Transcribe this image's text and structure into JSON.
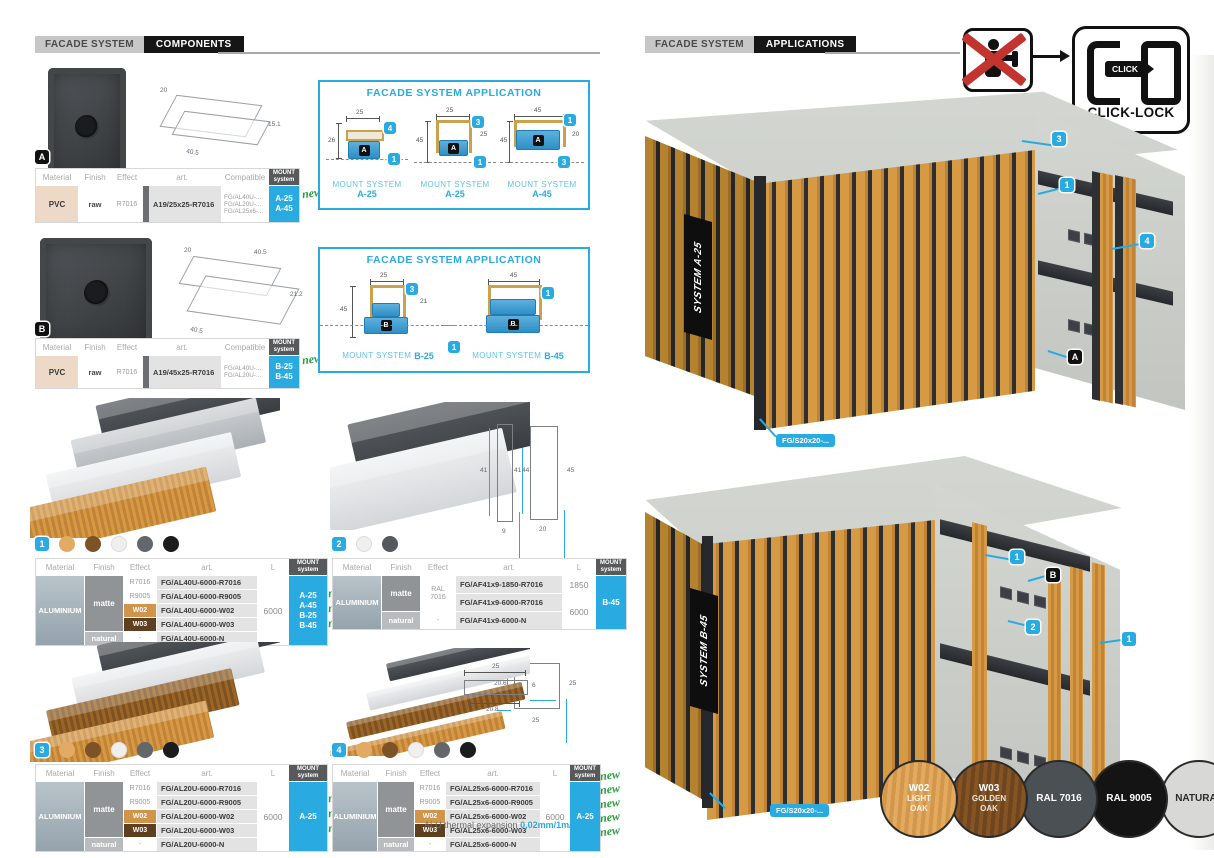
{
  "accent": "#29abe2",
  "labels": {
    "new": "new"
  },
  "table_headers": {
    "material": "Material",
    "finish": "Finish",
    "effect": "Effect",
    "art": "art.",
    "compatible": "Compatible",
    "l": "L",
    "mount1": "MOUNT",
    "mount2": "system"
  },
  "left": {
    "header": {
      "brand": "FACADE SYSTEM",
      "section": "COMPONENTS"
    },
    "compA": {
      "letter": "A",
      "dims": {
        "w": "20",
        "d": "40.5",
        "h": "15.1"
      },
      "table": {
        "material": "PVC",
        "finish": "raw",
        "effect": "R7016",
        "art": "A19/25x25-R7016",
        "compatible": [
          "FG/AL40U-...",
          "FG/AL20U-...",
          "FG/AL25x6-..."
        ],
        "mount": [
          "A-25",
          "A-45"
        ]
      }
    },
    "appA": {
      "title": "FACADE SYSTEM APPLICATION",
      "drawings": [
        {
          "mount_label": "MOUNT SYSTEM",
          "system": "A-25",
          "letter": "A",
          "dim_top": "25",
          "dim_left": "26",
          "dim_right": "6",
          "badge_top": "4",
          "badge_bottom": "1"
        },
        {
          "mount_label": "MOUNT SYSTEM",
          "system": "A-25",
          "letter": "A",
          "dim_top": "25",
          "dim_left": "45",
          "dim_right": "25",
          "badge_top": "3",
          "badge_bottom": "1"
        },
        {
          "mount_label": "MOUNT SYSTEM",
          "system": "A-45",
          "letter": "A",
          "dim_top": "45",
          "dim_left": "45",
          "dim_right": "20",
          "badge_top": "1",
          "badge_bottom": "3"
        }
      ]
    },
    "compB": {
      "letter": "B",
      "dims": {
        "w": "20",
        "d1": "40.5",
        "h": "21.2",
        "d2": "40.5"
      },
      "table": {
        "material": "PVC",
        "finish": "raw",
        "effect": "R7016",
        "art": "A19/45x25-R7016",
        "compatible": [
          "FG/AL40U-...",
          "FG/AL20U-..."
        ],
        "mount": [
          "B-25",
          "B-45"
        ]
      }
    },
    "appB": {
      "title": "FACADE SYSTEM APPLICATION",
      "badge_bottom": "1",
      "drawings": [
        {
          "mount_label": "MOUNT SYSTEM",
          "system": "B-25",
          "letter": "B",
          "dim_top": "25",
          "dim_left": "45",
          "dim_right": "21",
          "badge_top": "3"
        },
        {
          "mount_label": "MOUNT SYSTEM",
          "system": "B-45",
          "letter": "B",
          "dim_top": "45",
          "badge_top": "1"
        }
      ]
    },
    "profile1": {
      "num": "1",
      "dot_colors": [
        "#e2aa62",
        "#7d5226",
        "#efefed",
        "#63666a",
        "#1b1c1e"
      ],
      "dims": {
        "inner": "41",
        "outer": "45",
        "width": "20"
      },
      "table": {
        "material": "ALUMINIUM",
        "finish_matte": "matte",
        "finish_natural": "natural",
        "rows": [
          {
            "effect": "R7016",
            "art": "FG/AL40U-6000-R7016"
          },
          {
            "effect": "R9005",
            "art": "FG/AL40U-6000-R9005"
          },
          {
            "effect": "W02",
            "art": "FG/AL40U-6000-W02"
          },
          {
            "effect": "W03",
            "art": "FG/AL40U-6000-W03"
          },
          {
            "effect": "-",
            "art": "FG/AL40U-6000-N"
          }
        ],
        "length": "6000",
        "mount": [
          "A-25",
          "A-45",
          "B-25",
          "B-45"
        ]
      }
    },
    "profile2": {
      "num": "2",
      "dot_colors": [
        "#efefed",
        "#55585c"
      ],
      "dims": {
        "inner": "41",
        "outer": "44",
        "width": "9"
      },
      "table": {
        "material": "ALUMINIUM",
        "finish_matte": "matte",
        "finish_natural": "natural",
        "effect_matte1": "RAL",
        "effect_matte2": "7016",
        "effect_natural": "-",
        "rows": [
          {
            "art": "FG/AF41x9-1850-R7016",
            "l": "1850"
          },
          {
            "art": "FG/AF41x9-6000-R7016"
          },
          {
            "art": "FG/AF41x9-6000-N"
          }
        ],
        "length2": "6000",
        "mount": [
          "B-45"
        ]
      }
    },
    "profile3": {
      "num": "3",
      "dot_colors": [
        "#e2aa62",
        "#7d5226",
        "#efefed",
        "#63666a",
        "#1b1c1e"
      ],
      "dims": {
        "inner": "20.6",
        "outer": "25",
        "width": "25"
      },
      "table": {
        "material": "ALUMINIUM",
        "finish_matte": "matte",
        "finish_natural": "natural",
        "rows": [
          {
            "effect": "R7016",
            "art": "FG/AL20U-6000-R7016"
          },
          {
            "effect": "R9005",
            "art": "FG/AL20U-6000-R9005"
          },
          {
            "effect": "W02",
            "art": "FG/AL20U-6000-W02"
          },
          {
            "effect": "W03",
            "art": "FG/AL20U-6000-W03"
          },
          {
            "effect": "-",
            "art": "FG/AL20U-6000-N"
          }
        ],
        "length": "6000",
        "mount": [
          "A-25"
        ]
      }
    },
    "profile4": {
      "num": "4",
      "dot_colors": [
        "#e2aa62",
        "#7d5226",
        "#efefed",
        "#63666a",
        "#1b1c1e"
      ],
      "dims": {
        "top": "25",
        "inner": "20.8",
        "height": "6"
      },
      "table": {
        "material": "ALUMINIUM",
        "finish_matte": "matte",
        "finish_natural": "natural",
        "rows": [
          {
            "effect": "R7016",
            "art": "FG/AL25x6-6000-R7016"
          },
          {
            "effect": "R9005",
            "art": "FG/AL25x6-6000-R9005"
          },
          {
            "effect": "W02",
            "art": "FG/AL25x6-6000-W02"
          },
          {
            "effect": "W03",
            "art": "FG/AL25x6-6000-W03"
          },
          {
            "effect": "-",
            "art": "FG/AL25x6-6000-N"
          }
        ],
        "length": "6000",
        "mount": [
          "A-25"
        ]
      }
    },
    "note": {
      "text": "ALU thermal expansion ",
      "value": "0,02mm/1m/1°C"
    }
  },
  "right": {
    "header": {
      "brand": "FACADE SYSTEM",
      "section": "APPLICATIONS"
    },
    "clicklock": {
      "pill": "CLICK",
      "caption": "CLICK-LOCK"
    },
    "render1": {
      "plaque": "SYSTEM A-25",
      "badge1": "3",
      "badge2": "1",
      "badge3": "4",
      "letter": "A",
      "part_label": "FG/S20x20-..."
    },
    "render2": {
      "plaque": "SYSTEM B-45",
      "badge1": "1",
      "letter": "B",
      "badge2": "2",
      "badge3": "1",
      "part_label": "FG/S20x20-..."
    },
    "swatches": [
      {
        "code": "W02",
        "name1": "LIGHT",
        "name2": "OAK",
        "bg": "#dfa65c",
        "fg": "#ffffff"
      },
      {
        "code": "W03",
        "name1": "GOLDEN",
        "name2": "OAK",
        "bg": "#7a4e23",
        "fg": "#ffffff"
      },
      {
        "code": "RAL 7016",
        "bg": "#4b5055",
        "fg": "#ffffff"
      },
      {
        "code": "RAL 9005",
        "bg": "#141414",
        "fg": "#ffffff"
      },
      {
        "code": "NATURAL",
        "bg": "#d8d8d6",
        "fg": "#2b2b2b"
      }
    ]
  }
}
